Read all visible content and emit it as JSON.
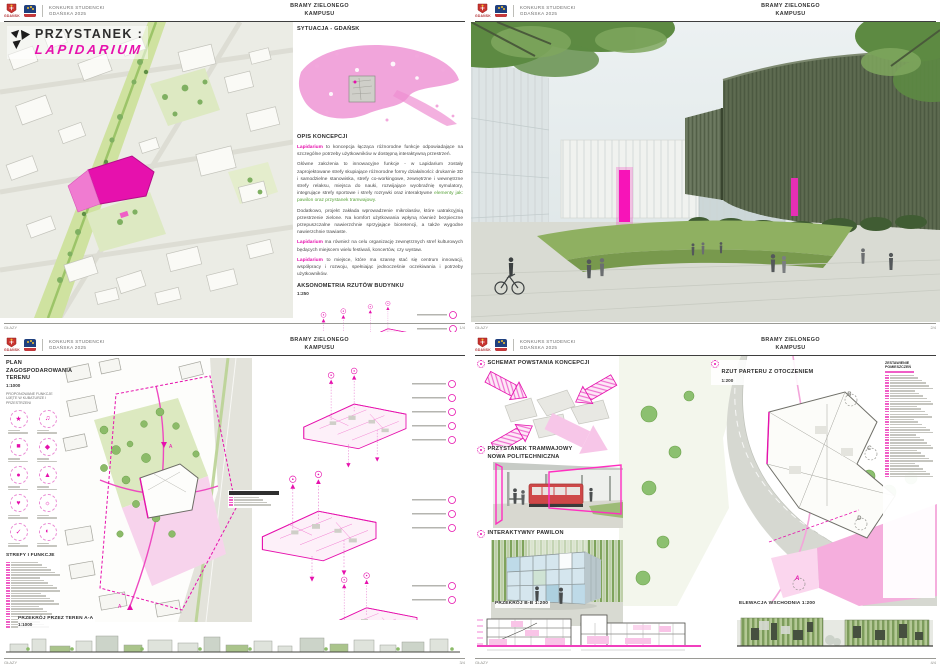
{
  "colors": {
    "magenta": "#e611ad",
    "pink_light": "#f5aedd",
    "green": "#7fa75e",
    "green_dark": "#4c6b3c",
    "text_dark": "#3a3a3a"
  },
  "header": {
    "logo_city": "GDAŃSK",
    "competition_line1": "KONKURS STUDENCKI",
    "competition_line2": "GDAŃSKA 2025",
    "board_title_line1": "BRAMY ZIELONEGO",
    "board_title_line2": "KAMPUSU"
  },
  "footer": {
    "code": "GŁAZY",
    "page1": "1/4",
    "page2": "2/4",
    "page3": "3/4",
    "page4": "4/4"
  },
  "panel1": {
    "title_line1": "PRZYSTANEK :",
    "title_line2": "LAPIDARIUM",
    "situation_heading": "SYTUACJA - GDAŃSK",
    "concept_heading": "OPIS KONCEPCJI",
    "lead": "Lapidarium",
    "p1": " to koncepcja łącząca różnorodne funkcje odpowiadające na szczególne potrzeby użytkowników w dostępną interaktywną przestrzeń.",
    "p2a": "Główne założenia to innowacyjne funkcje - w Lapidarium zostały zaprojektowane strefy skupiające różnorodne formy działalności: drukarnie 3D i samodzielne stanowiska, strefy co-workingowe, zewnętrzne i wewnętrzne strefy relaksu, miejsca do nauki, rozwijające wyobraźnię symulatory, integrujące strefy sportowe i strefy rozrywki oraz interaktywne ",
    "p2b": "elementy jak: pawilon oraz przystanek tramwajowy.",
    "p3": "Dodatkowo, projekt zakłada wprowadzenie mikrolasów, które uatrakcyjnią przestrzenie zielone. Na komfort użytkowania wpłyną również bezpieczne przepuszczalne nawierzchnie sprzyjające bioretencji, a także wygodne nawierzchnie trawiaste.",
    "p4": " ma również na celu organizację zewnętrznych stref kulturowych będących miejscem wielu festiwali, koncertów, czy wystaw.",
    "p5": " to miejsce, które ma szansę stać się centrum innowacji, współpracy i rozwoju, spełniając jednocześnie oczekiwania i potrzeby użytkowników.",
    "axon_heading": "AKSONOMETRIA RZUTÓW BUDYNKU",
    "axon_scale": "1:250"
  },
  "panel3": {
    "plan_heading": "PLAN ZAGOSPODAROWANIA TERENU",
    "plan_scale": "1:1000",
    "plan_sub1": "PROPONOWANE FUNKCJE",
    "plan_sub2": "UJĘTE W KUBATURZE I PRZESTRZENI",
    "zones_heading": "STREFY I FUNKCJE",
    "section_heading": "PRZEKRÓJ PRZEZ TEREN A-A",
    "section_scale": "1:1000",
    "legend_icons": [
      {
        "name": "function-icon-1",
        "glyph": "★"
      },
      {
        "name": "function-icon-2",
        "glyph": "♫"
      },
      {
        "name": "function-icon-3",
        "glyph": "■"
      },
      {
        "name": "function-icon-4",
        "glyph": "◆"
      },
      {
        "name": "function-icon-5",
        "glyph": "●"
      },
      {
        "name": "function-icon-6",
        "glyph": "▲"
      },
      {
        "name": "function-icon-7",
        "glyph": "♥"
      },
      {
        "name": "function-icon-8",
        "glyph": "☼"
      },
      {
        "name": "function-icon-9",
        "glyph": "✓"
      },
      {
        "name": "function-icon-10",
        "glyph": "◐"
      }
    ]
  },
  "panel4": {
    "schema_heading": "SCHEMAT POWSTANIA KONCEPCJI",
    "plan_heading": "RZUT PARTERU Z OTOCZENIEM",
    "plan_scale": "1:200",
    "tram_heading_line1": "PRZYSTANEK TRAMWAJOWY",
    "tram_heading_line2": "NOWA POLITECHNICZNA",
    "pavilion_heading": "INTERAKTYWNY PAWILON",
    "section_heading": "PRZEKRÓJ B-B 1:200",
    "elevation_heading": "ELEWACJA WSCHODNIA 1:200",
    "rooms_heading": "ZESTAWIENIE POMIESZCZEŃ",
    "markers": {
      "a": "A",
      "b": "B",
      "c": "C",
      "d": "D"
    }
  }
}
